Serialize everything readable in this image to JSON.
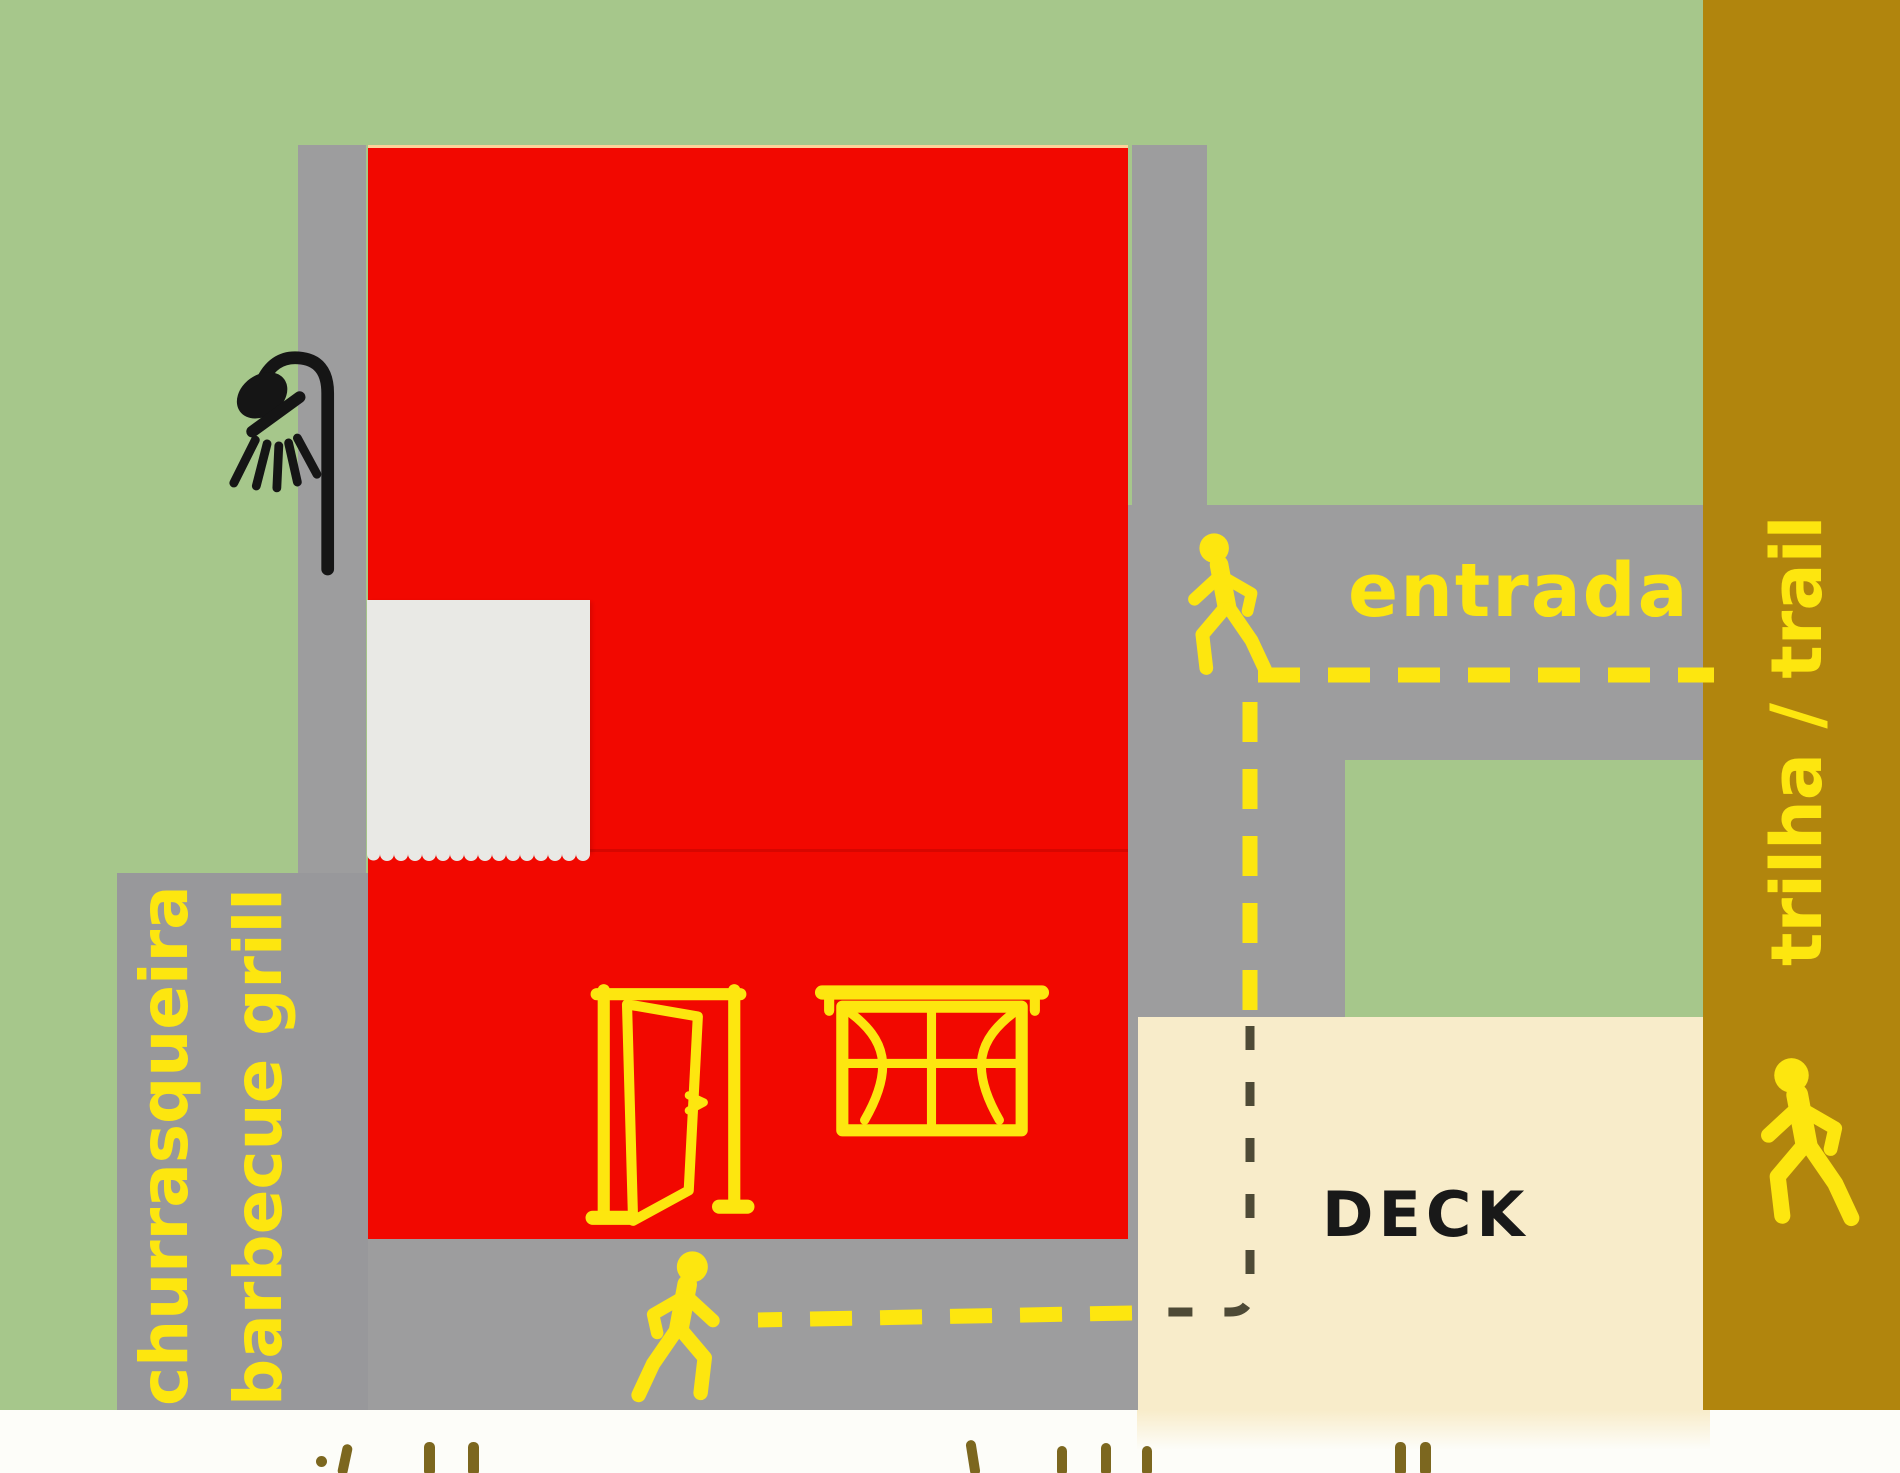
{
  "map": {
    "labels": {
      "entrada": "entrada",
      "trail": "trilha / trail",
      "churrasqueira": "churrasqueira",
      "barbecue_grill": "barbecue grill",
      "deck": "DECK"
    },
    "icons": [
      {
        "name": "shower-icon",
        "color": "#151515",
        "location": "left side of building"
      },
      {
        "name": "walking-person-icon",
        "color": "#fde60f",
        "location": "entrada path, facing left"
      },
      {
        "name": "walking-person-icon",
        "color": "#fde60f",
        "location": "bottom path, facing right"
      },
      {
        "name": "walking-person-icon",
        "color": "#fde60f",
        "location": "trail strip, facing left"
      },
      {
        "name": "door-icon",
        "color": "#fde60f",
        "location": "building lower wall"
      },
      {
        "name": "window-icon",
        "color": "#fde60f",
        "location": "building lower wall"
      }
    ],
    "routes": [
      {
        "name": "entrada-route",
        "style": "yellow dashed",
        "path": "from trail strip left along entrada path, then down"
      },
      {
        "name": "deck-route",
        "style": "dark dashed on deck",
        "path": "down across deck corner, then left"
      },
      {
        "name": "bottom-route",
        "style": "yellow dashed",
        "path": "left along bottom path to walker"
      }
    ],
    "colors": {
      "green": "#a6c78b",
      "red": "#f20800",
      "path-gray": "#9d9d9e",
      "path-gray-dark": "#98989b",
      "olive": "#b1850d",
      "yellow": "#fde60f",
      "deck-cream": "#f8ecca",
      "paper": "#e9e9e5",
      "bottom-white": "#fdfdf9",
      "ink": "#191919",
      "frag": "#7c671f",
      "dash-dark": "#4e4a36"
    },
    "bottom_text_cut_off": true
  }
}
